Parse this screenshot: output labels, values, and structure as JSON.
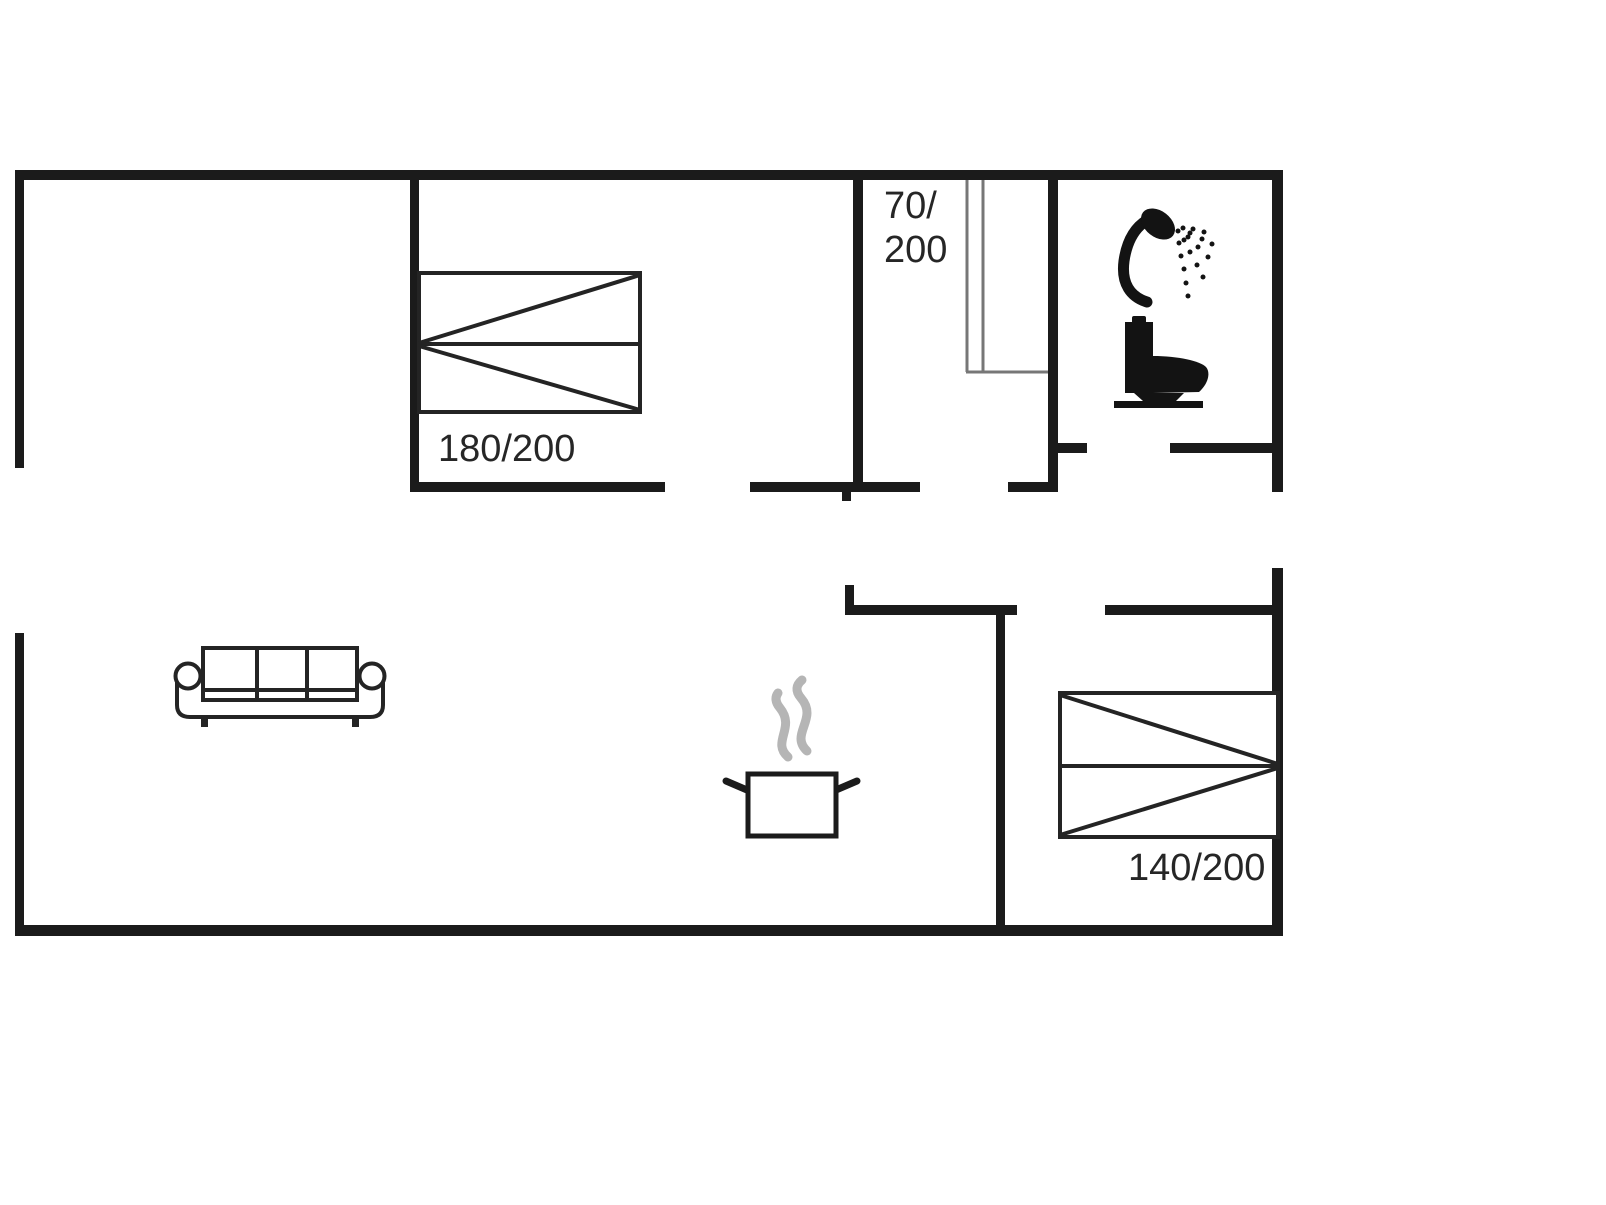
{
  "colors": {
    "wall": "#1b1b1b",
    "furniture_stroke": "#242424",
    "wardrobe_stroke": "#777777",
    "steam": "#b5b5b5",
    "fixture_fill": "#131313",
    "label_text": "#262626"
  },
  "labels": {
    "bed_large": "180/200",
    "bed_small": "140/200",
    "closet_top": "70/",
    "closet_bottom": "200"
  },
  "icons": {
    "bed_large": "double-bed-icon",
    "bed_small": "double-bed-icon",
    "wardrobe": "wardrobe-icon",
    "sofa": "sofa-icon",
    "pot": "cooking-pot-icon",
    "steam": "steam-icon",
    "shower": "shower-icon",
    "toilet": "toilet-icon"
  }
}
